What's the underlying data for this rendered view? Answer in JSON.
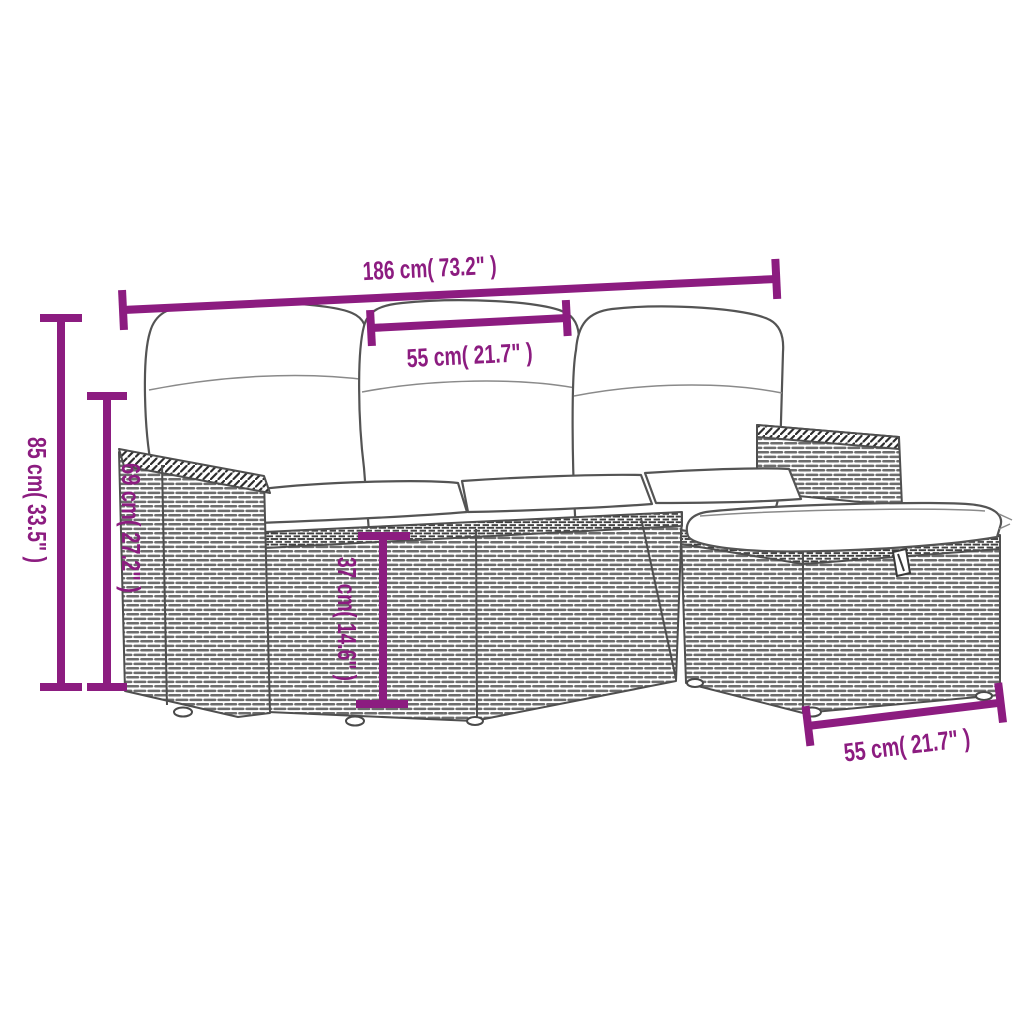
{
  "page": {
    "type": "product-dimension-diagram",
    "background_color": "#ffffff"
  },
  "palette": {
    "dimension_color": "#8C1C80",
    "line_art_color": "#4f4f4f",
    "rattan_texture_color": "#6d6d6d",
    "cushion_color": "#ffffff"
  },
  "illustration": {
    "description": "Outline sketch of a grey poly-rattan garden lounge set: three-seat sofa with left armrest, three back cushions, three seat cushions, right backrest panel and a storage ottoman with seat cushion and lid handle"
  },
  "dimensions": {
    "overall_width": {
      "label": "186 cm( 73.2\" )",
      "cm": 186,
      "inches": 73.2
    },
    "seat_module_width": {
      "label": "55 cm( 21.7\" )",
      "cm": 55,
      "inches": 21.7
    },
    "total_height": {
      "label": "85 cm( 33.5\" )",
      "cm": 85,
      "inches": 33.5
    },
    "backrest_height": {
      "label": "69 cm( 27.2\" )",
      "cm": 69,
      "inches": 27.2
    },
    "seat_height": {
      "label": "37 cm( 14.6\" )",
      "cm": 37,
      "inches": 14.6
    },
    "ottoman_width": {
      "label": "55 cm( 21.7\" )",
      "cm": 55,
      "inches": 21.7
    }
  }
}
